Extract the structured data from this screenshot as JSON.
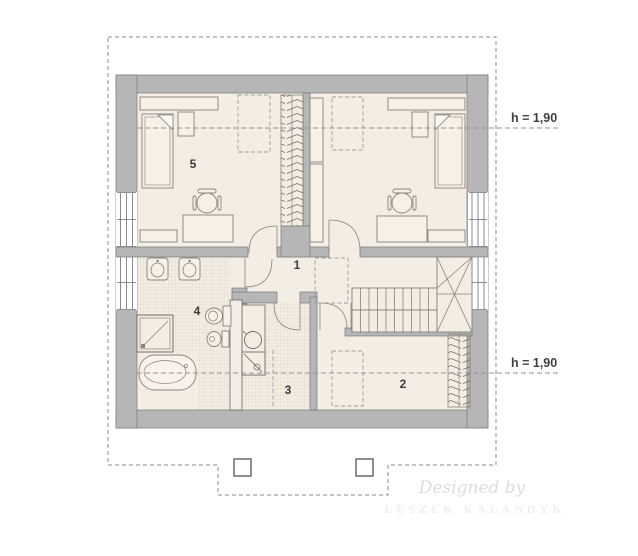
{
  "plan": {
    "room_labels": {
      "r1": "1",
      "r2": "2",
      "r3": "3",
      "r4": "4",
      "r5": "5"
    },
    "height_labels": {
      "upper": "h = 1,90",
      "lower": "h = 1,90"
    },
    "watermark": {
      "line1": "Designed by",
      "line2": "LESZEK KALANDYK"
    },
    "colors": {
      "wall": "#b6b6b6",
      "wall_outline": "#7a7a7a",
      "floor": "#f4ede3",
      "furniture_fill": "#f6f0e7",
      "drawing_line": "#87827a",
      "dashed_line": "#9b9b9b",
      "label_text": "#3b3b3b",
      "watermark_script": "#dcdcdc",
      "watermark_caps": "#efefef"
    }
  }
}
